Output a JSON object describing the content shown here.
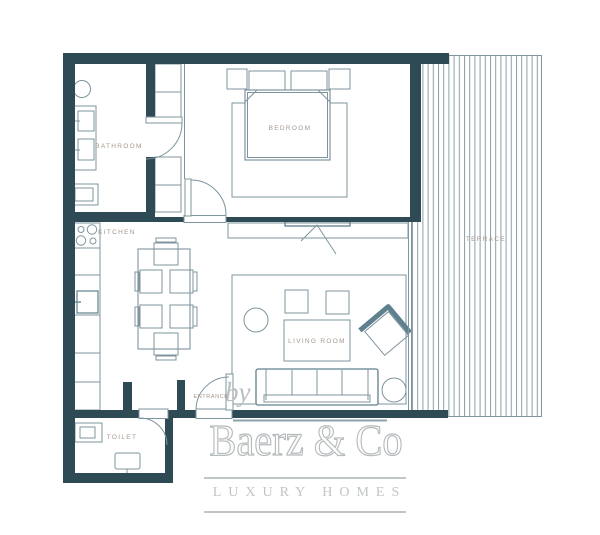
{
  "floor_plan": {
    "rooms": {
      "bathroom": {
        "label": "BATHROOM"
      },
      "bedroom": {
        "label": "BEDROOM"
      },
      "kitchen": {
        "label": "KITCHEN"
      },
      "living_room": {
        "label": "LIVING ROOM"
      },
      "terrace": {
        "label": "TERRACE"
      },
      "entrance": {
        "label": "ENTRANCE"
      },
      "toilet": {
        "label": "TOILET"
      }
    },
    "colors": {
      "wall": "#2e4a54",
      "furniture_line": "#7e949e",
      "room_label": "#a4978e",
      "logo_gray": "#bfc4c5"
    }
  },
  "branding": {
    "byline": "by",
    "brand_name": "Baerz & Co",
    "tagline": "LUXURY HOMES"
  }
}
